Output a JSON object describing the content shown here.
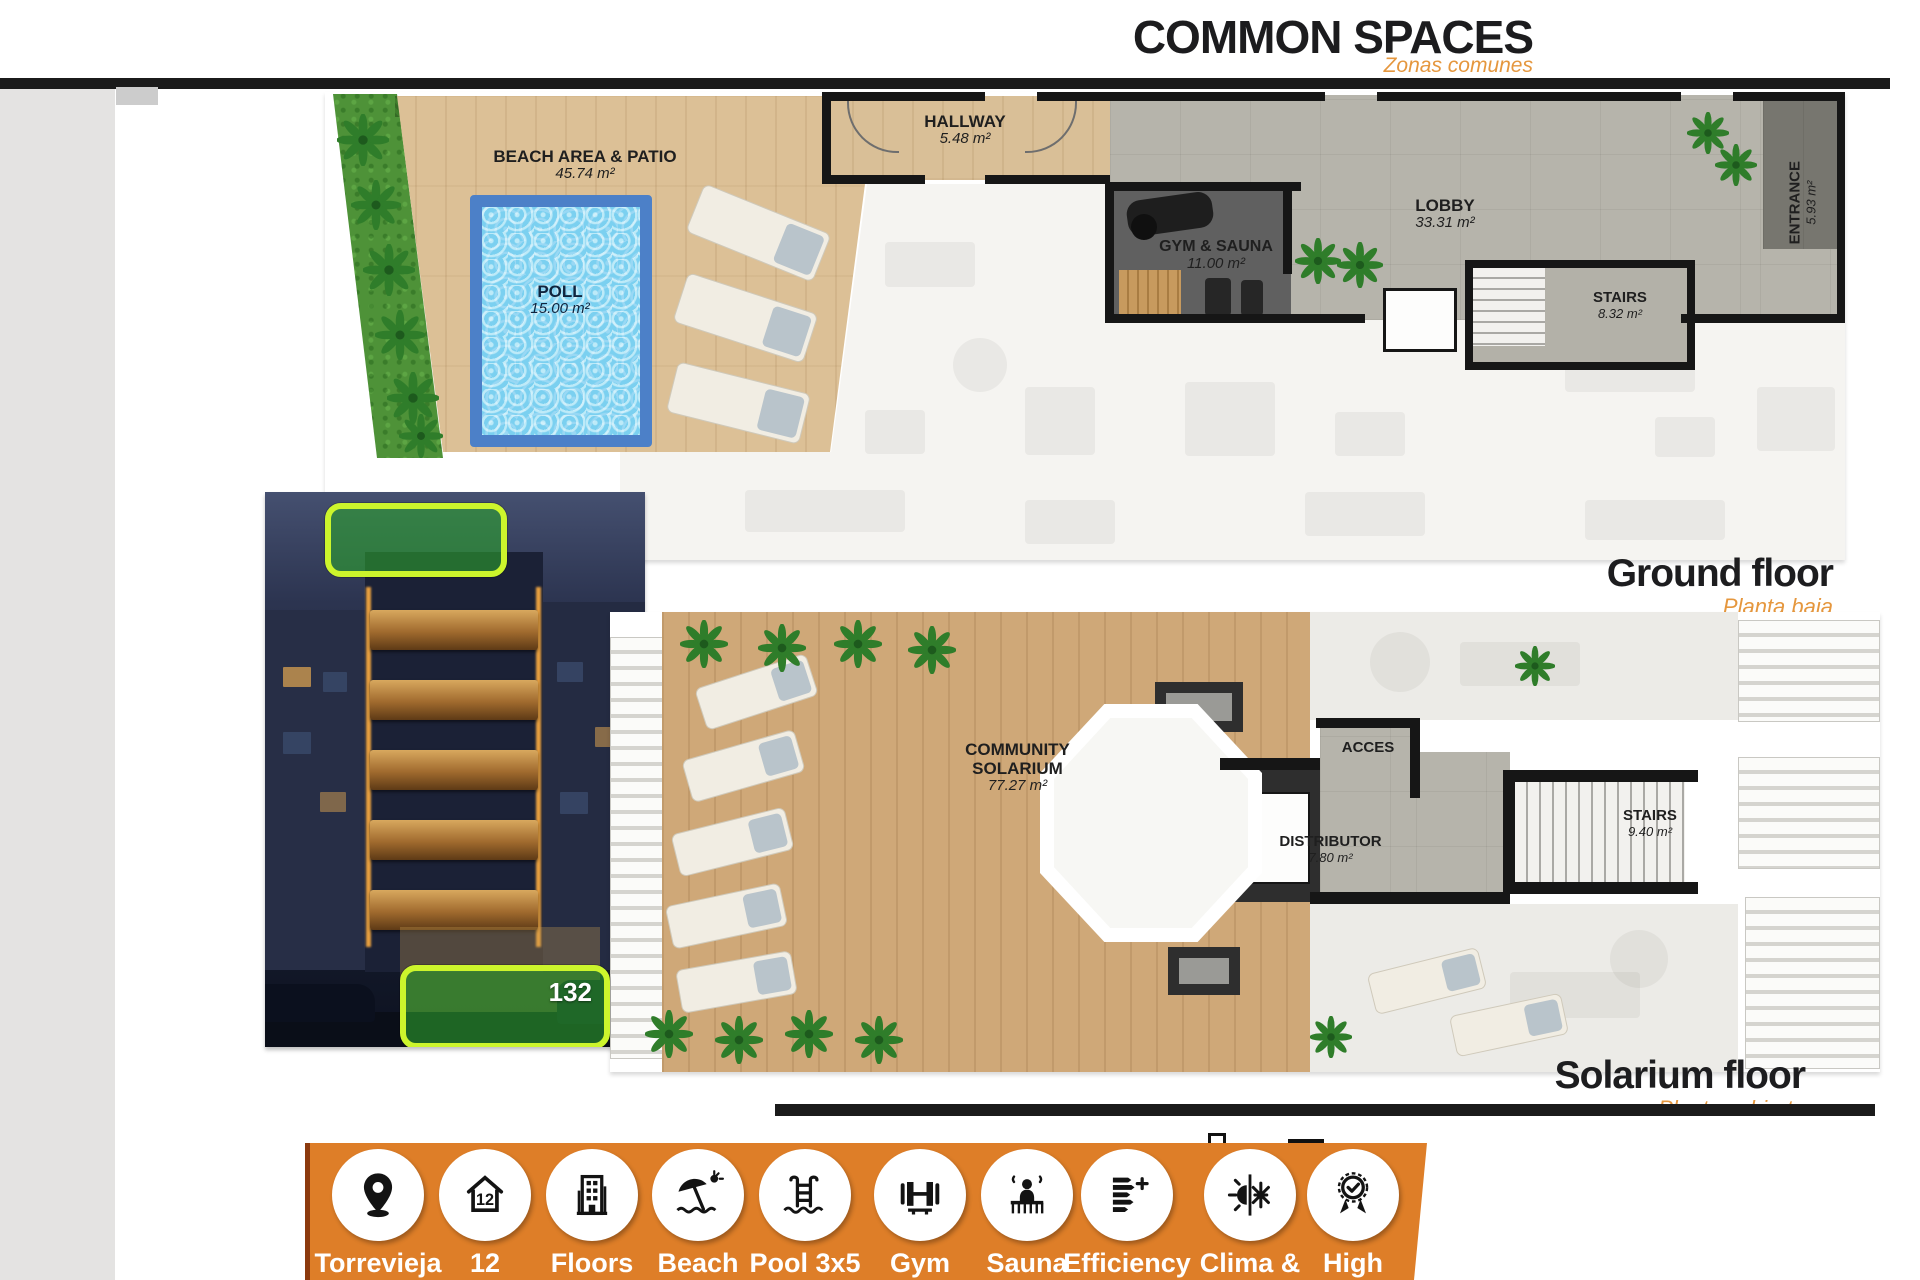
{
  "header": {
    "title": "COMMON SPACES",
    "subtitle": "Zonas comunes"
  },
  "ground": {
    "caption": "Ground floor",
    "caption_es": "Planta baja",
    "beach": {
      "name": "BEACH AREA & PATIO",
      "area": "45.74 m²"
    },
    "pool": {
      "name": "POLL",
      "area": "15.00 m²"
    },
    "hallway": {
      "name": "HALLWAY",
      "area": "5.48 m²"
    },
    "gym": {
      "name": "GYM & SAUNA",
      "area": "11.00 m²"
    },
    "lobby": {
      "name": "LOBBY",
      "area": "33.31 m²"
    },
    "stairs": {
      "name": "STAIRS",
      "area": "8.32 m²"
    },
    "entrance": {
      "name": "ENTRANCE",
      "area": "5.93 m²"
    }
  },
  "solarium": {
    "caption": "Solarium floor",
    "caption_es": "Planta cubierta",
    "community": {
      "name": "COMMUNITY SOLARIUM",
      "area": "77.27 m²"
    },
    "acces": {
      "name": "ACCES"
    },
    "distributor": {
      "name": "DISTRIBUTOR",
      "area": "7.80 m²"
    },
    "stairs": {
      "name": "STAIRS",
      "area": "9.40 m²"
    }
  },
  "photo": {
    "badge": "132"
  },
  "features": [
    {
      "icon": "location-pin-icon",
      "line1": "Torrevieja",
      "line2": "(Alicante)"
    },
    {
      "icon": "house-12-icon",
      "line1": "12",
      "line2": "Apartments"
    },
    {
      "icon": "building-icon",
      "line1": "Floors",
      "line2": "6"
    },
    {
      "icon": "beach-umbrella-icon",
      "line1": "Beach",
      "line2": "200 m"
    },
    {
      "icon": "pool-ladder-icon",
      "line1": "Pool 3x5",
      "line2": "15 m²"
    },
    {
      "icon": "barbell-icon",
      "line1": "Gym",
      "line2": "10 m²"
    },
    {
      "icon": "sauna-icon",
      "line1": "Sauna",
      "line2": "6 pers"
    },
    {
      "icon": "efficiency-icon",
      "line1": "Efficiency",
      "line2": "A+"
    },
    {
      "icon": "climate-icon",
      "line1": "Clima &",
      "line2": "Heating"
    },
    {
      "icon": "award-icon",
      "line1": "High",
      "line2": "quality"
    }
  ],
  "colors": {
    "banner_orange": "#de7e28",
    "accent_orange": "#e5973e",
    "highlight_green": "#2da52d",
    "highlight_ring": "#ccf52c",
    "pool_blue": "#86d9f3",
    "bar_black": "#1b1b1b"
  }
}
